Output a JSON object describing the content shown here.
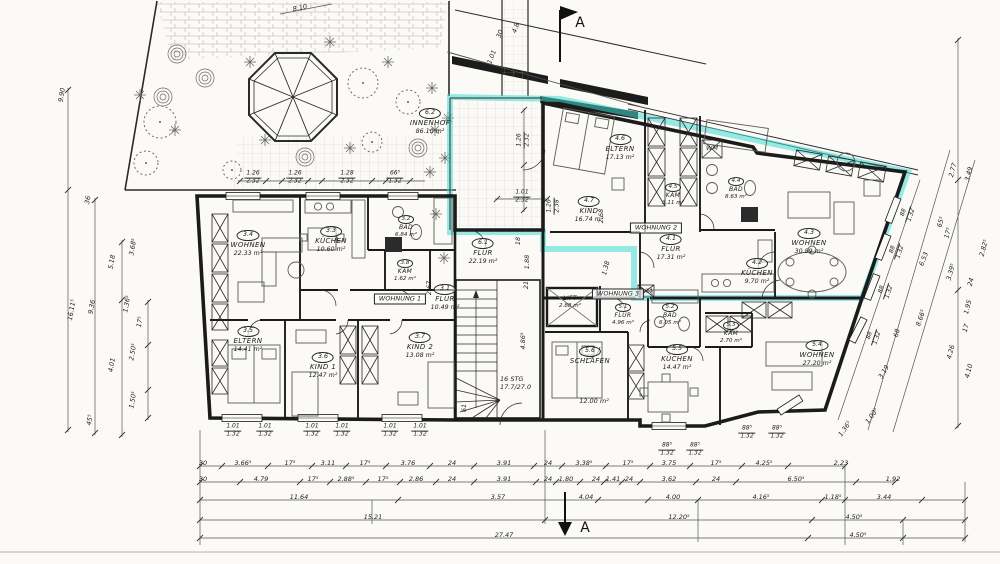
{
  "markers": {
    "section_top": "A",
    "section_bottom": "A"
  },
  "labels": {
    "wohnung1": "WOHNUNG 1",
    "wohnung2": "WOHNUNG 2",
    "wohnung3": "WOHNUNG 3",
    "wm_top": "WM",
    "wm_mid": "WM",
    "lift_name": "LIFT",
    "lift_area": "2.88 m²",
    "stairs_line1": "16 STG",
    "stairs_line2": "17.7/27.0"
  },
  "rooms": {
    "innenhof": {
      "id": "6.2",
      "name": "INNENHOF",
      "area": "86.10 m²"
    },
    "hall": {
      "id": "6.1",
      "name": "FLUR",
      "area": "22.19 m²"
    },
    "w1": [
      {
        "id": "3.4",
        "name": "WOHNEN",
        "area": "22.33 m²"
      },
      {
        "id": "3.3",
        "name": "KÜCHEN",
        "area": "10.60 m²"
      },
      {
        "id": "3.2",
        "name": "BAD",
        "area": "6.84 m²"
      },
      {
        "id": "3.8",
        "name": "KAM",
        "area": "1.62 m²"
      },
      {
        "id": "3.1",
        "name": "FLUR",
        "area": "10.49 m²"
      },
      {
        "id": "3.5",
        "name": "ELTERN",
        "area": "14.41 m²"
      },
      {
        "id": "3.6",
        "name": "KIND 1",
        "area": "12.47 m²"
      },
      {
        "id": "3.7",
        "name": "KIND 2",
        "area": "13.08 m²"
      }
    ],
    "w2": [
      {
        "id": "4.6",
        "name": "ELTERN",
        "area": "17.13 m²"
      },
      {
        "id": "4.5",
        "name": "KAM",
        "area": "3.11 m²"
      },
      {
        "id": "4.4",
        "name": "BAD",
        "area": "8.63 m²"
      },
      {
        "id": "4.7",
        "name": "KIND",
        "area": "16.74 m²"
      },
      {
        "id": "4.1",
        "name": "FLUR",
        "area": "17.31 m²"
      },
      {
        "id": "4.3",
        "name": "WOHNEN",
        "area": "30.89 m²"
      },
      {
        "id": "4.2",
        "name": "KÜCHEN",
        "area": "9.70 m²"
      }
    ],
    "w3": [
      {
        "id": "5.1",
        "name": "FLUR",
        "area": "4.96 m²"
      },
      {
        "id": "5.2",
        "name": "BAD",
        "area": "6.05 m²"
      },
      {
        "id": "5.3",
        "name": "KAM",
        "area": "2.70 m²"
      },
      {
        "id": "5.6",
        "name": "SCHLAFEN",
        "area": "12.00 m²"
      },
      {
        "id": "5.5",
        "name": "KÜCHEN",
        "area": "14.47 m²"
      },
      {
        "id": "5.4",
        "name": "WOHNEN",
        "area": "27.20 m²"
      }
    ]
  },
  "dims": {
    "rowA": [
      "30",
      "3.66⁵",
      "17⁵",
      "3.11",
      "17⁵",
      "3.76",
      "24",
      "3.91",
      "24",
      "3.38⁵",
      "17⁵",
      "3.75",
      "17⁵",
      "4.25⁵",
      "2.23"
    ],
    "rowB": [
      "30",
      "4.79",
      "17⁵",
      "2.88⁵",
      "17⁵",
      "2.86",
      "24",
      "3.91",
      "24",
      "1.80",
      "24",
      "1.41",
      "24",
      "3.62",
      "24",
      "6.50⁵",
      "1.92"
    ],
    "rowC": [
      "11.64",
      "3.57",
      "4.04",
      "4.00",
      "4.16⁵",
      "1.18⁵",
      "3.44"
    ],
    "rowD": [
      "15.21",
      "12.20⁵",
      "4.50⁵"
    ],
    "rowE": [
      "27.47",
      "4.50⁵"
    ],
    "left": [
      "9.90",
      "36",
      "3.68⁵",
      "5.18",
      "1.36⁵",
      "17⁵",
      "9.36",
      "16.11⁵",
      "4.01",
      "2.50⁵",
      "1.50⁵",
      "45⁵"
    ],
    "right": [
      "2.77",
      "3.49",
      "65⁵",
      "17⁵",
      "2.82⁵",
      "6.53",
      "3.39⁵",
      "24",
      "1.95",
      "17",
      "8.66⁵",
      "4.26",
      "4.10",
      "3.19"
    ],
    "misc": [
      "1.88",
      "21",
      "18",
      "1.38",
      "4.86⁵",
      "2.67",
      "2.68",
      "61",
      "30",
      "1.01",
      "4.8",
      "8.10",
      "68",
      "1.36⁵",
      "1.00⁵"
    ],
    "garden": [
      {
        "t": "1.26",
        "b": "2.32"
      },
      {
        "t": "1.26",
        "b": "2.32"
      },
      {
        "t": "1.28",
        "b": "2.32"
      },
      {
        "t": "66⁵",
        "b": "1.32"
      }
    ],
    "terrace_v": {
      "t": "1.26",
      "b": "2.32"
    },
    "terrace_h": {
      "t": "1.01",
      "b": "2.32"
    },
    "terrace_v2": {
      "t": "1.26",
      "b": "2.38"
    },
    "win_bl": [
      {
        "t": "1.01",
        "b": "1.32"
      },
      {
        "t": "1.01",
        "b": "1.32"
      },
      {
        "t": "1.01",
        "b": "1.32"
      },
      {
        "t": "1.01",
        "b": "1.32"
      },
      {
        "t": "1.01",
        "b": "1.32"
      },
      {
        "t": "1.01",
        "b": "1.32"
      }
    ],
    "win_bm": [
      {
        "t": "88⁵",
        "b": "1.32"
      },
      {
        "t": "88⁵",
        "b": "1.32"
      }
    ],
    "win_bm2": [
      {
        "t": "88⁵",
        "b": "1.32"
      },
      {
        "t": "88⁵",
        "b": "1.32"
      }
    ],
    "win_right": [
      {
        "t": "88",
        "b": "1.32"
      },
      {
        "t": "88",
        "b": "1.32"
      },
      {
        "t": "88",
        "b": "1.32"
      },
      {
        "t": "88",
        "b": "1.32"
      }
    ]
  }
}
